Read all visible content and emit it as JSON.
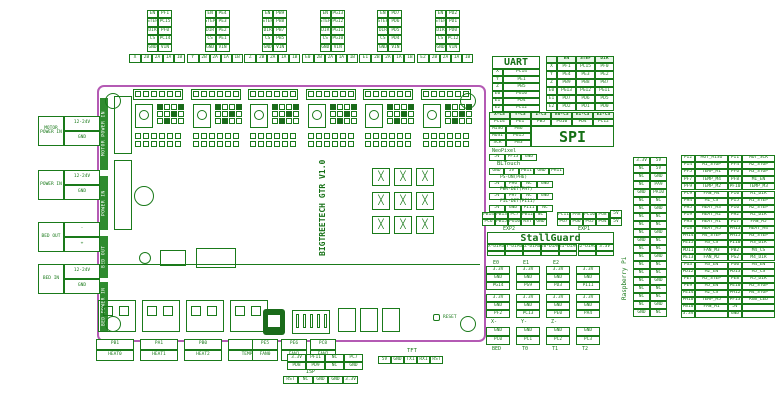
{
  "colors": {
    "green": "#1a7a1a",
    "dark_green": "#1a6b1a",
    "bar_green": "#2f8b2f",
    "magenta": "#b45ab4",
    "header_bg": "#e9f6e9"
  },
  "board": {
    "title": "BIGTREETECH GTR V1.0",
    "reset_label": "RESET",
    "left_bars": [
      "MOTOR POWER IN",
      "POWER IN",
      "BED OUT",
      "BED POWER IN"
    ]
  },
  "left_labels": [
    {
      "title": "MOTOR POWER IN",
      "cells": [
        "12-24V",
        "GND"
      ]
    },
    {
      "title": "POWER IN",
      "cells": [
        "12-24V",
        "GND"
      ]
    },
    {
      "title": "BED OUT",
      "cells": [
        "-",
        "+"
      ]
    },
    {
      "title": "BED IN",
      "cells": [
        "12-24V",
        "GND"
      ]
    }
  ],
  "drivers": [
    {
      "name": "X",
      "en": "PF1",
      "step": "PC15",
      "dir": "PF0",
      "cs": "PC14"
    },
    {
      "name": "Y",
      "en": "PE4",
      "step": "PE3",
      "dir": "PE2",
      "cs": "PE1"
    },
    {
      "name": "Z",
      "en": "PB9",
      "step": "PB8",
      "dir": "PB7",
      "cs": "PB5"
    },
    {
      "name": "E0",
      "en": "PG13",
      "step": "PG12",
      "dir": "PG11",
      "cs": "PG10"
    },
    {
      "name": "E1",
      "en": "PD7",
      "step": "PD6",
      "dir": "PD5",
      "cs": "PD4"
    },
    {
      "name": "E2",
      "en": "PD2",
      "step": "PD1",
      "dir": "PD0",
      "cs": "PC12"
    }
  ],
  "top_connector": {
    "row_labels": [
      "EN",
      "STEP",
      "DIR",
      "CS",
      "GND"
    ],
    "last_value": "VIN",
    "motor_cells": [
      "2B",
      "2A",
      "1A",
      "1B"
    ]
  },
  "uart_table": {
    "title": "UART"
  },
  "esd_table": {
    "header": [
      "EN",
      "STEP",
      "DIR"
    ]
  },
  "spi_block": {
    "title": "SPI",
    "cs_suffix": "-CS",
    "rows": [
      [
        "MISO",
        "PB6"
      ],
      [
        "MOSI",
        "PG15"
      ],
      [
        "SCK",
        "PB3"
      ]
    ]
  },
  "neopixel": {
    "title": "NeoPixel",
    "cells": [
      "5V",
      "PF13",
      "GND"
    ]
  },
  "bltouch": {
    "title": "BLTouch",
    "cells": [
      "GND",
      "5V",
      "PB11",
      "GND",
      "PH11"
    ]
  },
  "aux_connectors": [
    {
      "title": "PS-ON(PH6)",
      "cells": [
        "5V",
        "PH6",
        "NC",
        "GND"
      ]
    },
    {
      "title": "PWR-DET(PH7)",
      "cells": [
        "5V",
        "PH7",
        "NC",
        "GND"
      ]
    },
    {
      "title": "FIL-DET(PI11)",
      "cells": [
        "5V",
        "GND",
        "PI11",
        "NC"
      ]
    }
  ],
  "exp": [
    {
      "caption": "EXP2",
      "rows": [
        [
          "PB14",
          "PB13",
          "PC7",
          "PB12",
          "NC"
        ],
        [
          "PC6",
          "PB15",
          "PG10",
          "RST",
          "GND"
        ]
      ]
    },
    {
      "caption": "EXP1",
      "rows": [
        [
          "PC11",
          "PA8",
          "PC10",
          "PG8",
          "5V"
        ],
        [
          "PG7",
          "PG6",
          "PG5",
          "PG4",
          "GND"
        ]
      ]
    }
  ],
  "stallguard": {
    "title": "StallGuard",
    "cells": [
      "X-DIAG",
      "Y-DIAG",
      "Z-DIAG",
      "E0-DIAG",
      "E1-DIAG",
      "E2-DIAG",
      "3.3V"
    ]
  },
  "endstops": {
    "top_labels": [
      "E0",
      "E1",
      "E2",
      ""
    ],
    "top_groups": [
      [
        "3.3V",
        "GND",
        "PG14"
      ],
      [
        "3.3V",
        "GND",
        "PG9"
      ],
      [
        "3.3V",
        "GND",
        "PD3"
      ],
      [
        "3.3V",
        "GND",
        "PI11"
      ]
    ],
    "bottom_groups": [
      [
        "3.3V",
        "GND",
        "PF2"
      ],
      [
        "3.3V",
        "GND",
        "PC13"
      ],
      [
        "3.3V",
        "GND",
        "PE0"
      ],
      [
        "3.3V",
        "GND",
        "PA4"
      ]
    ],
    "bottom_labels": [
      "X-",
      "Y-",
      "Z-",
      ""
    ]
  },
  "thermistors": {
    "groups": [
      [
        "GND",
        "PC0"
      ],
      [
        "GND",
        "PC1"
      ],
      [
        "GND",
        "PC2"
      ],
      [
        "GND",
        "PC3"
      ]
    ],
    "labels": [
      "BED",
      "T0",
      "T1",
      "T2"
    ]
  },
  "heaters": [
    {
      "pin": "PB1",
      "label": "HEAT0"
    },
    {
      "pin": "PA1",
      "label": "HEAT1"
    },
    {
      "pin": "PB0",
      "label": "HEAT2"
    },
    {
      "pin": "",
      "label": "TEMP"
    }
  ],
  "fans": [
    {
      "pin": "PE5",
      "label": "FAN0"
    },
    {
      "pin": "PE6",
      "label": "FAN1"
    },
    {
      "pin": "PC8",
      "label": "FAN2"
    }
  ],
  "wifi": {
    "title": "WIFI",
    "rows": [
      [
        "3.3V",
        "PF11",
        "NC",
        "PC7"
      ],
      [
        "PD8",
        "PD9",
        "NC",
        "GND"
      ]
    ]
  },
  "isp": {
    "title": "ISP",
    "cells": [
      "RST",
      "NC",
      "GND",
      "GND",
      "3.3V"
    ]
  },
  "tft": {
    "title": "TFT",
    "cells": [
      "5V",
      "GND",
      "TX1",
      "RX1",
      "RST"
    ]
  },
  "rpi": {
    "title": "Raspberry Pi",
    "jumper": [
      "5V",
      "5V"
    ],
    "left": [
      "3.3V",
      "NC",
      "NC",
      "NC",
      "GND",
      "NC",
      "NC",
      "NC",
      "NC",
      "NC",
      "GND",
      "NC",
      "NC",
      "NC",
      "NC",
      "NC",
      "NC",
      "NC",
      "NC",
      "GND"
    ],
    "right": [
      "5V",
      "5V",
      "GND",
      "PA9",
      "PA10",
      "NC",
      "GND",
      "NC",
      "NC",
      "GND",
      "NC",
      "NC",
      "GND",
      "NC",
      "NC",
      "GND",
      "NC",
      "NC",
      "GND",
      "NC"
    ]
  },
  "expansion_table": {
    "rows": [
      [
        "PI2",
        "MOT_MISO",
        "PI1",
        "MOT_SCK"
      ],
      [
        "PI4",
        "M1_STOP",
        "PF4",
        "M2_STOP"
      ],
      [
        "PF5",
        "TEMP_M1",
        "PF6",
        "M3_STOP"
      ],
      [
        "PF7",
        "TEMP_M4",
        "PF8",
        "M1_EN"
      ],
      [
        "PF9",
        "TEMP_M2",
        "PF10",
        "TEMP_M3"
      ],
      [
        "PC9",
        "FAN_M4",
        "PI0",
        "M1_DIR"
      ],
      [
        "PH4",
        "M1_CS",
        "PI5",
        "M1_STEP"
      ],
      [
        "PH5",
        "HEAT_M3",
        "PI6",
        "M2_STEP"
      ],
      [
        "PI9",
        "HEAT_M2",
        "PH2",
        "M2_DIR"
      ],
      [
        "PH3",
        "HEAT_M1",
        "PI7",
        "FAN_M5"
      ],
      [
        "PI8",
        "HEAT_M5",
        "PH13",
        "HEAT_M4"
      ],
      [
        "PH14",
        "M4_STEP",
        "PH15",
        "M3_STEP"
      ],
      [
        "PE15",
        "M3_CS",
        "PI10",
        "M3_DIR"
      ],
      [
        "PD11",
        "FAN_M3",
        "PB2",
        "M4_CS"
      ],
      [
        "PE13",
        "FAN_M2",
        "PG2",
        "M4_DIR"
      ],
      [
        "PG3",
        "M3_EN",
        "PG0",
        "M4_EN"
      ],
      [
        "PD12",
        "M2_EN",
        "PD13",
        "M5_CS"
      ],
      [
        "PE7",
        "M5_STEP",
        "PE8",
        "M5_DIR"
      ],
      [
        "PE9",
        "M5_EN",
        "PE10",
        "M5_STOP"
      ],
      [
        "PE14",
        "M2_CS",
        "PH12",
        "M4_STOP"
      ],
      [
        "PH10",
        "TEMP_M5",
        "PF13",
        "RGB_LED"
      ],
      [
        "PB10",
        "FAN_M1",
        "5V",
        ""
      ],
      [
        "3.3V",
        "",
        "GND",
        ""
      ]
    ]
  }
}
